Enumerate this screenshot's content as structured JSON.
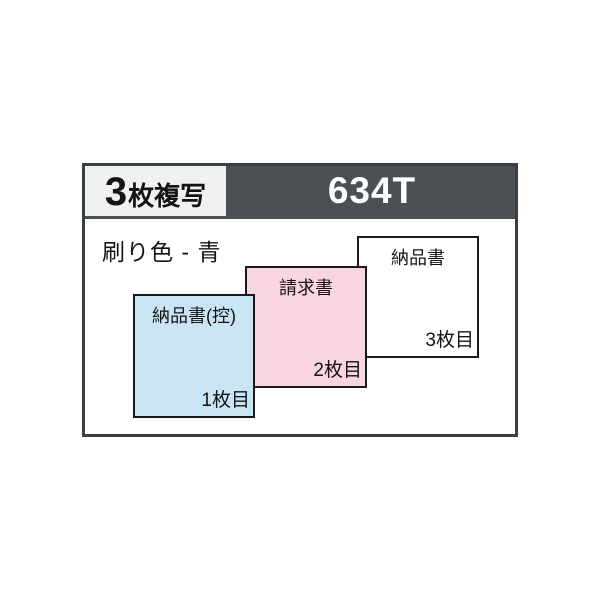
{
  "header": {
    "copies_count": "3",
    "copies_label": "枚複写",
    "model": "634T"
  },
  "body": {
    "print_color_label": "刷り色 - 青"
  },
  "sheets": [
    {
      "title": "納品書(控)",
      "number": "1枚目",
      "color": "#c9e4f5"
    },
    {
      "title": "請求書",
      "number": "2枚目",
      "color": "#f9d4e3"
    },
    {
      "title": "納品書",
      "number": "3枚目",
      "color": "#ffffff"
    }
  ],
  "colors": {
    "frame_border": "#3a3f44",
    "header_bg": "#4b5055",
    "badge_bg": "#f0f1f1",
    "model_text": "#ffffff",
    "sheet_border": "#1a1a1a",
    "text": "#141414"
  }
}
